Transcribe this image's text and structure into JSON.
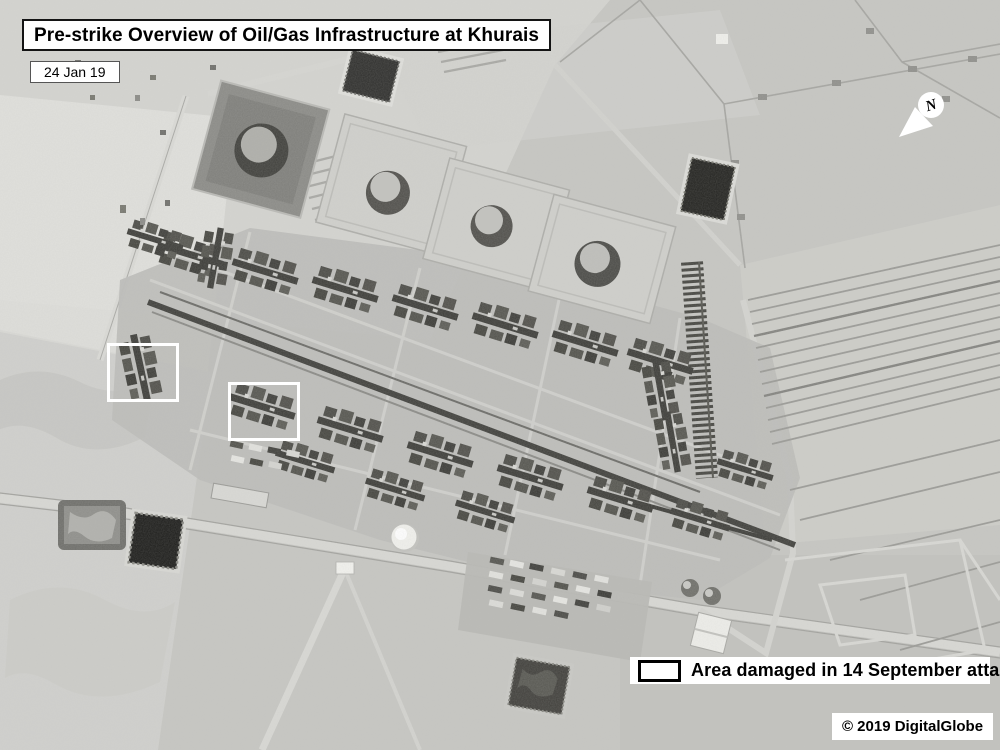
{
  "annotations": {
    "title": "Pre-strike Overview of Oil/Gas Infrastructure at Khurais",
    "capture_date": "24 Jan 19",
    "compass_label": "N",
    "legend_label": "Area damaged in 14 September attack",
    "credit": "© 2019 DigitalGlobe"
  },
  "markers": {
    "outline_color": "#ffffff",
    "damage_areas": [
      {
        "x": 107,
        "y": 343,
        "width": 66,
        "height": 53
      },
      {
        "x": 228,
        "y": 382,
        "width": 66,
        "height": 53
      }
    ]
  },
  "colors": {
    "annotation_background": "#ffffff",
    "annotation_text": "#000000",
    "annotation_border": "#000000",
    "desert_base": "#c6c6c2"
  }
}
